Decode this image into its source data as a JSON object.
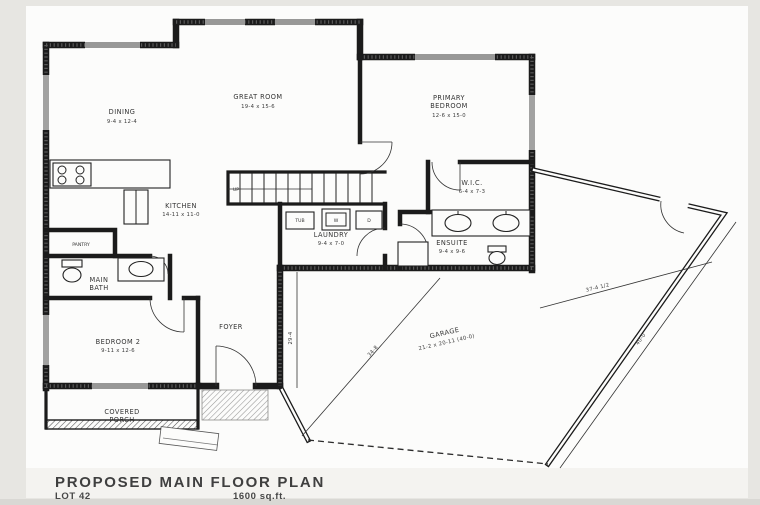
{
  "title_block": {
    "title": "PROPOSED MAIN FLOOR PLAN",
    "lot": "LOT 42",
    "area": "1600 sq.ft."
  },
  "rooms": {
    "dining": {
      "name": "DINING",
      "dims": "9-4 x 12-4"
    },
    "great_room": {
      "name": "GREAT ROOM",
      "dims": "19-4 x 15-6"
    },
    "primary": {
      "line1": "PRIMARY",
      "line2": "BEDROOM",
      "dims": "12-6 x 15-0"
    },
    "kitchen": {
      "name": "KITCHEN",
      "dims": "14-11 x 11-0"
    },
    "pantry": {
      "name": "PANTRY"
    },
    "main_bath": {
      "line1": "MAIN",
      "line2": "BATH"
    },
    "bedroom2": {
      "name": "BEDROOM 2",
      "dims": "9-11 x 12-6"
    },
    "porch": {
      "line1": "COVERED",
      "line2": "PORCH"
    },
    "foyer": {
      "name": "FOYER"
    },
    "laundry": {
      "name": "LAUNDRY",
      "dims": "9-4 x 7-0"
    },
    "wic": {
      "name": "W.I.C.",
      "dims": "6-4 x 7-3"
    },
    "ensuite": {
      "name": "ENSUITE",
      "dims": "9-4 x 9-6"
    },
    "garage": {
      "name": "GARAGE",
      "dims": "21-2 x 20-11 (40-0)"
    }
  },
  "fixtures": {
    "tub": "TUB",
    "washer": "W",
    "dryer": "D",
    "stairs": "UP"
  },
  "dimensions": {
    "foyer_wall": "29-4",
    "garage_depth": "34-8",
    "garage_offset": "37-4 1/2",
    "garage_width": "40-0"
  },
  "colors": {
    "wall": "#1b1b1b",
    "sheet": "#fcfcfb",
    "background": "#efeeeb"
  }
}
